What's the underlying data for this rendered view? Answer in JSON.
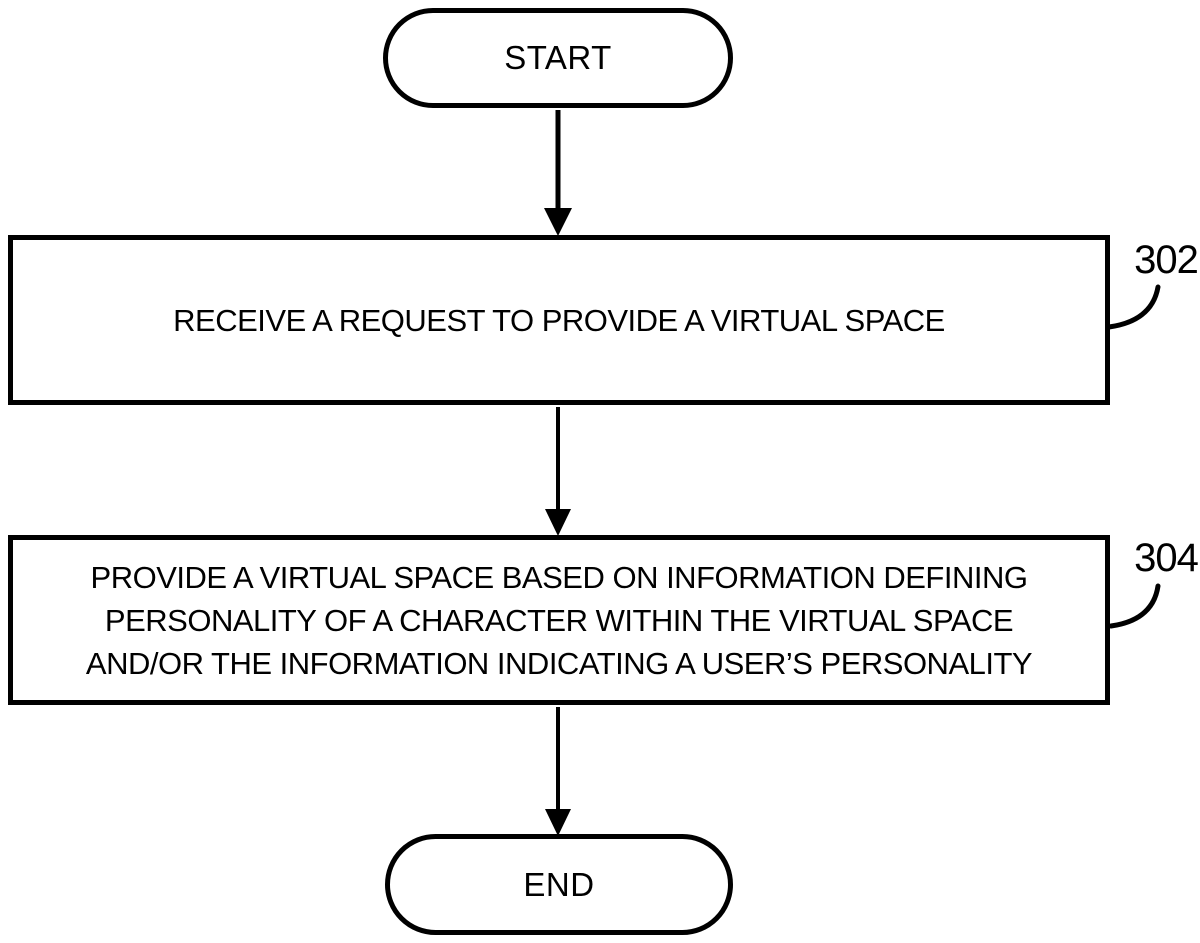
{
  "diagram": {
    "type": "flowchart",
    "background_color": "#ffffff",
    "stroke_color": "#000000",
    "start": {
      "label": "START"
    },
    "end": {
      "label": "END"
    },
    "steps": [
      {
        "ref": "302",
        "lines": [
          "RECEIVE A REQUEST TO PROVIDE A VIRTUAL SPACE"
        ]
      },
      {
        "ref": "304",
        "lines": [
          "PROVIDE A VIRTUAL SPACE BASED ON INFORMATION DEFINING",
          "PERSONALITY OF A CHARACTER WITHIN THE VIRTUAL SPACE",
          "AND/OR THE INFORMATION INDICATING A USER’S PERSONALITY"
        ]
      }
    ],
    "flow": [
      "START",
      "302",
      "304",
      "END"
    ]
  }
}
